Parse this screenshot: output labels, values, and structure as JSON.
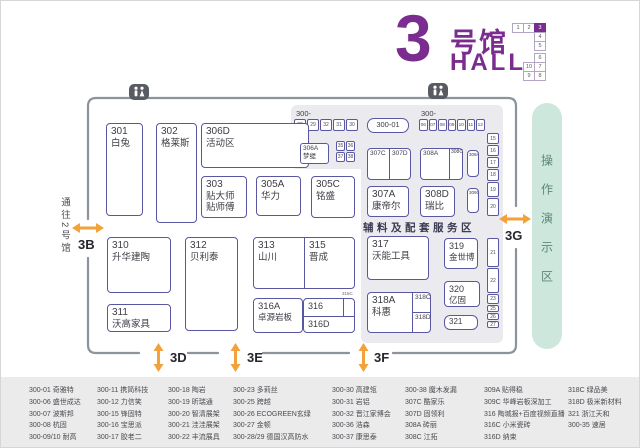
{
  "title": {
    "big": "3",
    "cn": "号馆",
    "en": "HALL"
  },
  "minimap": {
    "cells": [
      "1",
      "2",
      "3",
      "4",
      "5",
      "6",
      "10",
      "7",
      "9",
      "8"
    ],
    "active": "3"
  },
  "entrances": {
    "corridor_label": "通往2号馆",
    "gates": {
      "b": "3B",
      "d": "3D",
      "e": "3E",
      "f": "3F",
      "g": "3G"
    }
  },
  "demo_area": {
    "label": "操作演示区"
  },
  "service_area": {
    "label": "辅料及配套服务区"
  },
  "icons": {
    "restroom": "restroom-icon"
  },
  "booths": {
    "b301": {
      "num": "301",
      "name": "白兔"
    },
    "b302": {
      "num": "302",
      "name": "格莱斯"
    },
    "b306D": {
      "num": "306D",
      "name": "活动区"
    },
    "b303": {
      "num": "303",
      "name": "贴大师\n贴师傅"
    },
    "b305A": {
      "num": "305A",
      "name": "华力"
    },
    "b305C": {
      "num": "305C",
      "name": "铭盛"
    },
    "b306A": {
      "num": "306A",
      "name": "梦缇"
    },
    "b300_01": {
      "num": "300-01"
    },
    "b307C": {
      "num": "307C"
    },
    "b307D": {
      "num": "307D"
    },
    "b308A": {
      "num": "308A"
    },
    "b308C": {
      "num": "308C"
    },
    "b309A": {
      "num": "309A"
    },
    "b309C": {
      "num": "309C"
    },
    "b307A": {
      "num": "307A",
      "name": "康帝尔"
    },
    "b308D": {
      "num": "308D",
      "name": "瑞比"
    },
    "b310": {
      "num": "310",
      "name": "升华建陶"
    },
    "b311": {
      "num": "311",
      "name": "沃高家具"
    },
    "b312": {
      "num": "312",
      "name": "贝利泰"
    },
    "b313": {
      "num": "313",
      "name": "山川"
    },
    "b315": {
      "num": "315",
      "name": "晋成"
    },
    "b316A": {
      "num": "316A",
      "name": "卓源岩板"
    },
    "b316": {
      "num": "316"
    },
    "b316C": {
      "num": "316C"
    },
    "b316D": {
      "num": "316D"
    },
    "b317": {
      "num": "317",
      "name": "沃能工具"
    },
    "b319": {
      "num": "319",
      "name": "金世博"
    },
    "b320": {
      "num": "320",
      "name": "亿固"
    },
    "b318A": {
      "num": "318A",
      "name": "科惠"
    },
    "b318C": {
      "num": "318C"
    },
    "b318D": {
      "num": "318D"
    },
    "b321": {
      "num": "321"
    }
  },
  "strips": {
    "left_label": "300-",
    "left": [
      "28",
      "29",
      "32",
      "31",
      "30"
    ],
    "mid_grid": [
      "35",
      "36",
      "37",
      "38"
    ],
    "right_label": "300-",
    "right": [
      "06",
      "07",
      "08",
      "09",
      "10",
      "11",
      "12"
    ],
    "col_upper": [
      "15",
      "16",
      "17",
      "18",
      "19",
      "20"
    ],
    "col_lower": [
      "21",
      "22",
      "23",
      "25",
      "26",
      "27"
    ]
  },
  "legend": {
    "columns": [
      {
        "items": [
          "300-01 奇雅特",
          "300-06 盛世成达",
          "300-07 波斯邦",
          "300-08 杭固",
          "300-09/10 耐高"
        ]
      },
      {
        "items": [
          "300-11 携简科技",
          "300-12 力信笑",
          "300-15 锋固特",
          "300-16 宝思派",
          "300-17 胶老二"
        ]
      },
      {
        "items": [
          "300-18 陶岩",
          "300-19 昕瑞通",
          "300-20 智清展架",
          "300-21 洼洼展架",
          "300-22 丰流展具"
        ]
      },
      {
        "items": [
          "300-23 多莉丝",
          "300-25 跨越",
          "300-26 ECOGREEN玄绿",
          "300-27 金顿",
          "300-28/29 德国汉高防水"
        ]
      },
      {
        "items": [
          "300-30 高建瓴",
          "300-31 岩铝",
          "300-32 晋江家博会",
          "300-36 浩森",
          "300-37 康思泰"
        ]
      },
      {
        "items": [
          "300-38 魔木发漏",
          "307C 酷家乐",
          "307D 固领利",
          "308A 砖丽",
          "308C 江拓"
        ]
      },
      {
        "items": [
          "309A 贴得稳",
          "309C 华峰岩板深加工",
          "316 陶城报+百度视频直播",
          "316C 小米瓷砖",
          "316D 纳束"
        ]
      },
      {
        "items": [
          "318C 绿品美",
          "318D 极米新材料",
          "321 浙江天和",
          "300-35 速居"
        ]
      }
    ]
  },
  "colors": {
    "purple": "#7b2c8f",
    "orange": "#f2a239",
    "booth_border": "#5a57a2",
    "demo_bg": "#cde7dc",
    "demo_text": "#5e8778",
    "panel": "#ebebef",
    "wall": "#8d939b"
  }
}
